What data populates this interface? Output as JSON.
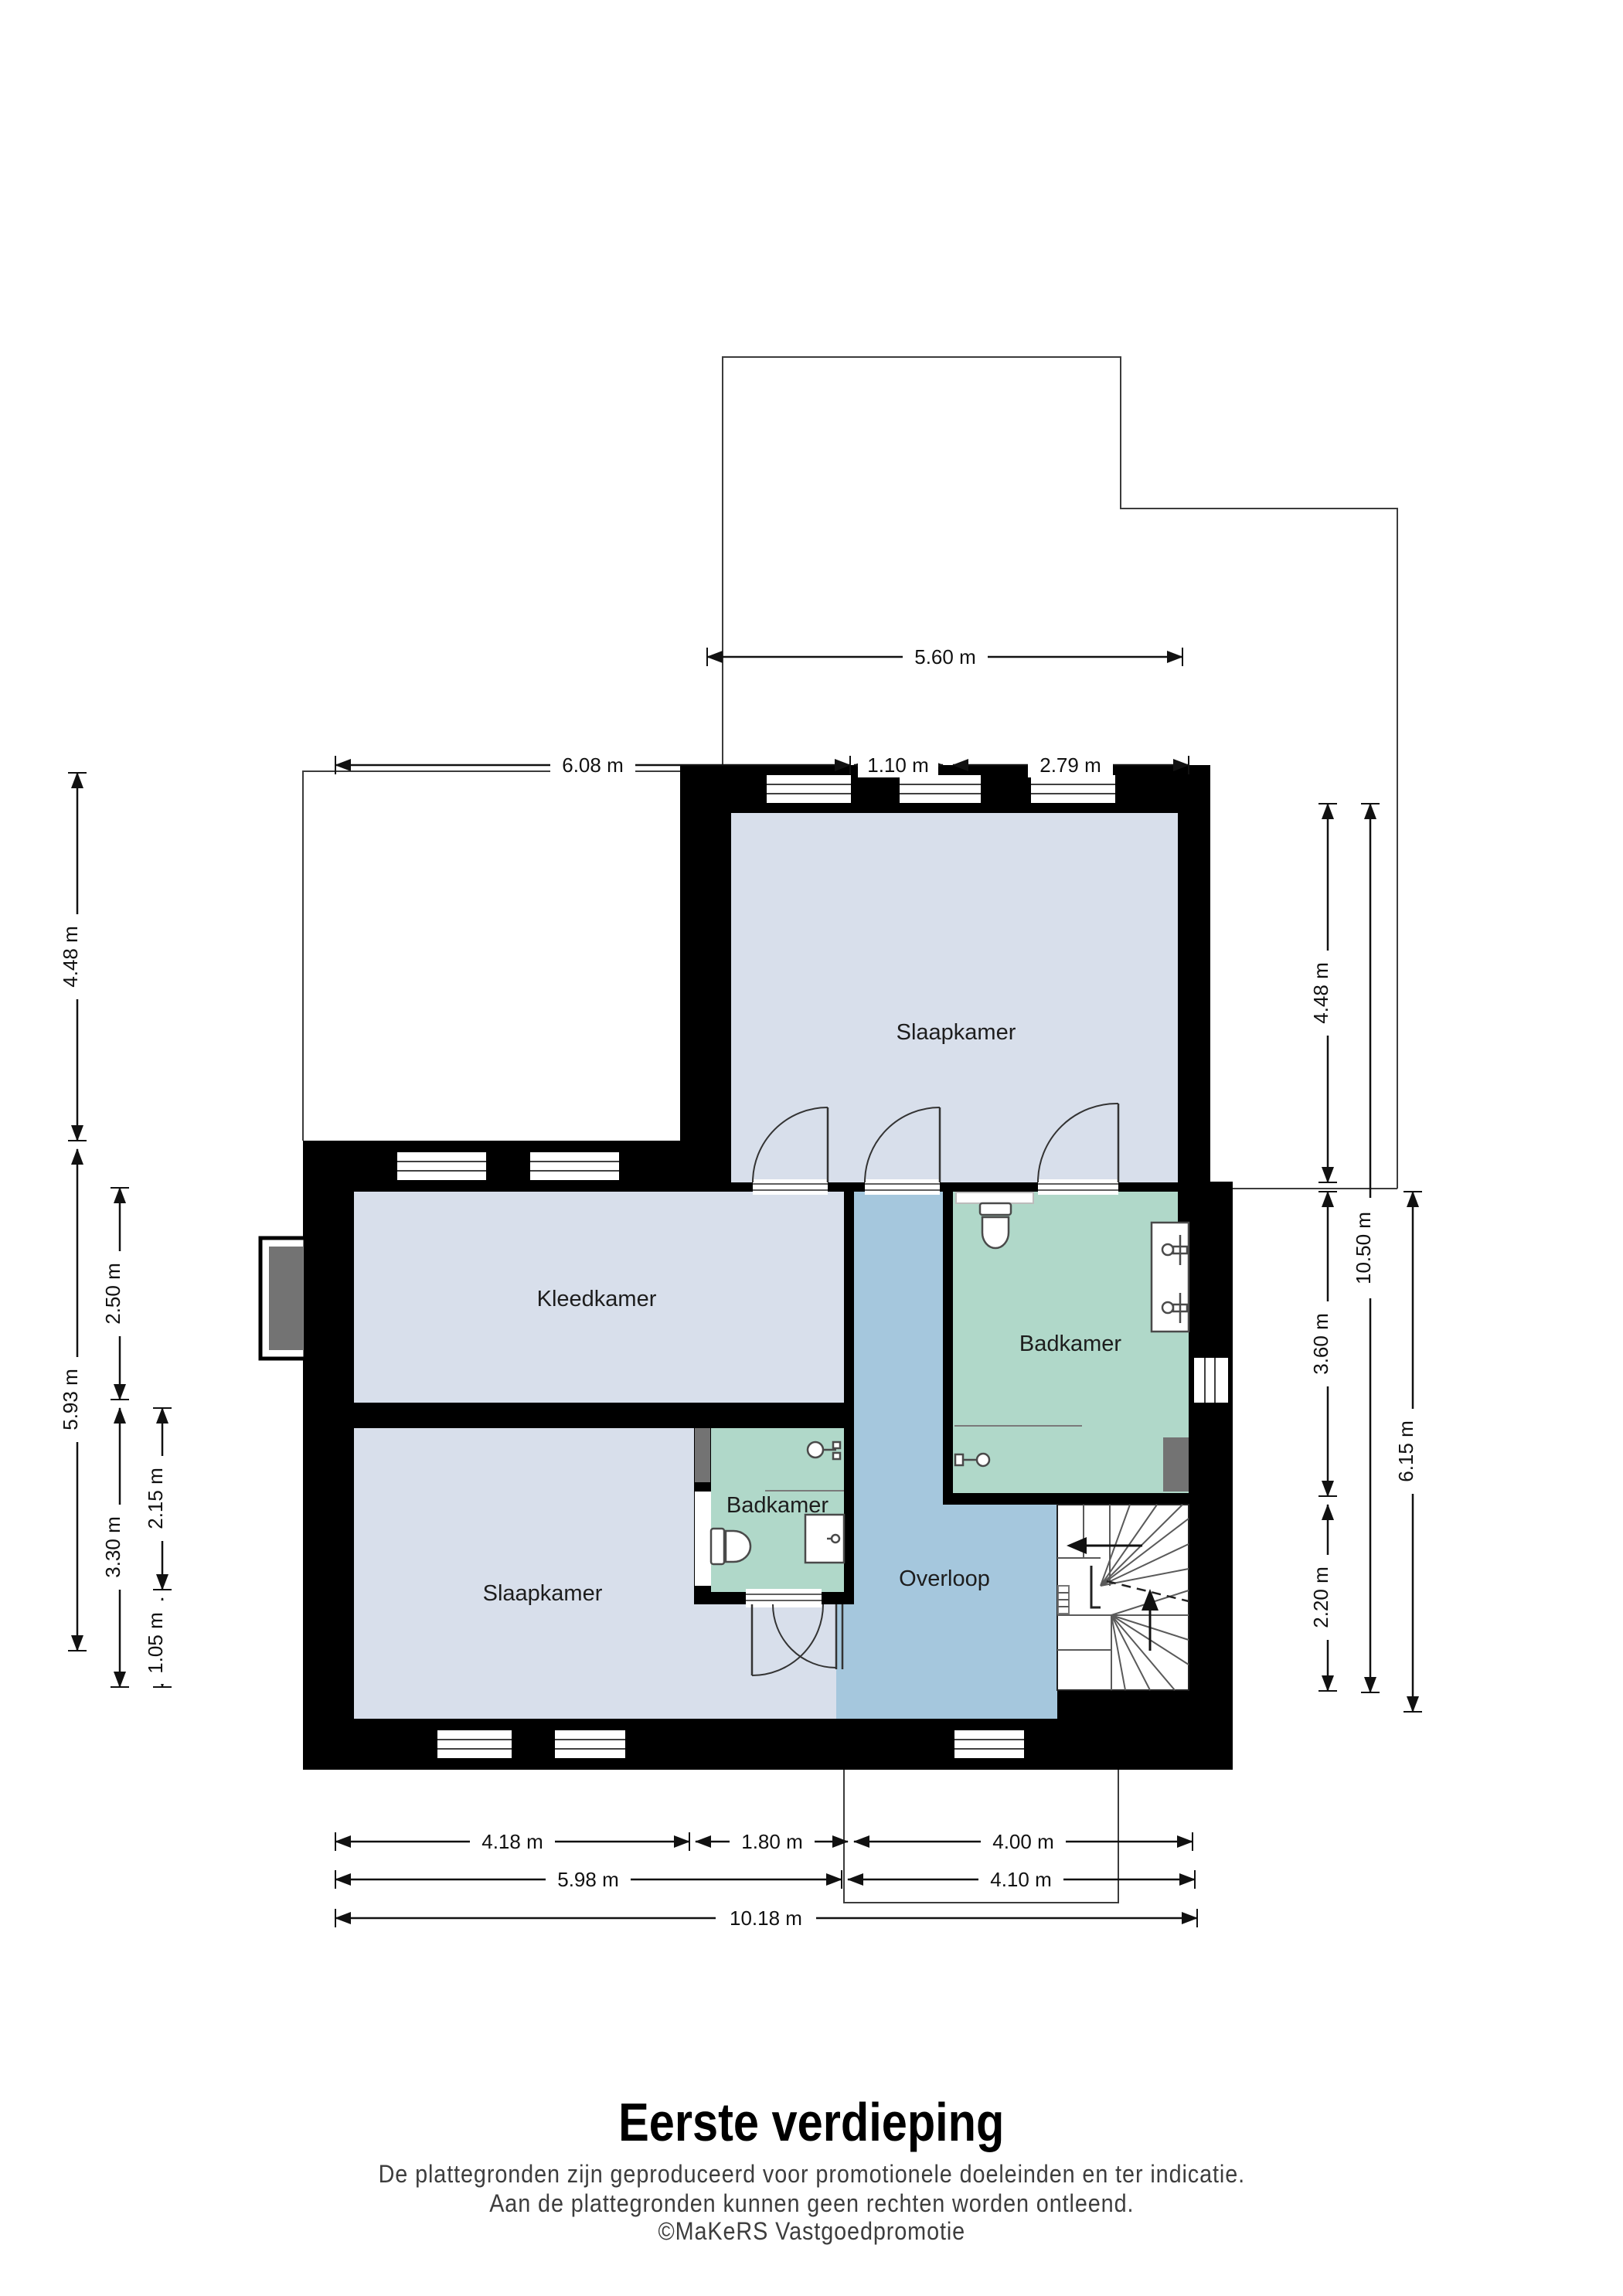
{
  "floorplan": {
    "title": "Eerste verdieping",
    "disclaimer1": "De plattegronden zijn geproduceerd voor promotionele doeleinden en ter indicatie.",
    "disclaimer2": "Aan de plattegronden kunnen geen rechten worden ontleend.",
    "credit": "©MaKeRS Vastgoedpromotie"
  },
  "rooms": {
    "bedroom_top": {
      "label": "Slaapkamer"
    },
    "dressing_room": {
      "label": "Kleedkamer"
    },
    "bedroom_bottom": {
      "label": "Slaapkamer"
    },
    "bathroom_small": {
      "label": "Badkamer"
    },
    "bathroom_large": {
      "label": "Badkamer"
    },
    "landing": {
      "label": "Overloop"
    }
  },
  "dimensions": {
    "top": [
      {
        "label": "5.60 m"
      },
      {
        "label": "6.08 m"
      },
      {
        "label": "1.10 m"
      },
      {
        "label": "2.79 m"
      }
    ],
    "left": [
      {
        "label": "4.48 m"
      },
      {
        "label": "5.93 m"
      },
      {
        "label": "2.50 m"
      },
      {
        "label": "3.30 m"
      },
      {
        "label": "2.15 m"
      },
      {
        "label": "1.05 m"
      }
    ],
    "right": [
      {
        "label": "4.48 m"
      },
      {
        "label": "3.60 m"
      },
      {
        "label": "2.20 m"
      },
      {
        "label": "10.50 m"
      },
      {
        "label": "6.15 m"
      }
    ],
    "bottom": [
      {
        "label": "4.18 m"
      },
      {
        "label": "1.80 m"
      },
      {
        "label": "4.00 m"
      },
      {
        "label": "5.98 m"
      },
      {
        "label": "4.10 m"
      },
      {
        "label": "10.18 m"
      }
    ]
  },
  "colors": {
    "wall": "#000000",
    "room_light": "#d8dfeb",
    "landing_blue": "#a5c7dd",
    "bathroom_mint": "#b0d8c9",
    "duct_gray": "#737373",
    "dimension_text": "#111111"
  }
}
